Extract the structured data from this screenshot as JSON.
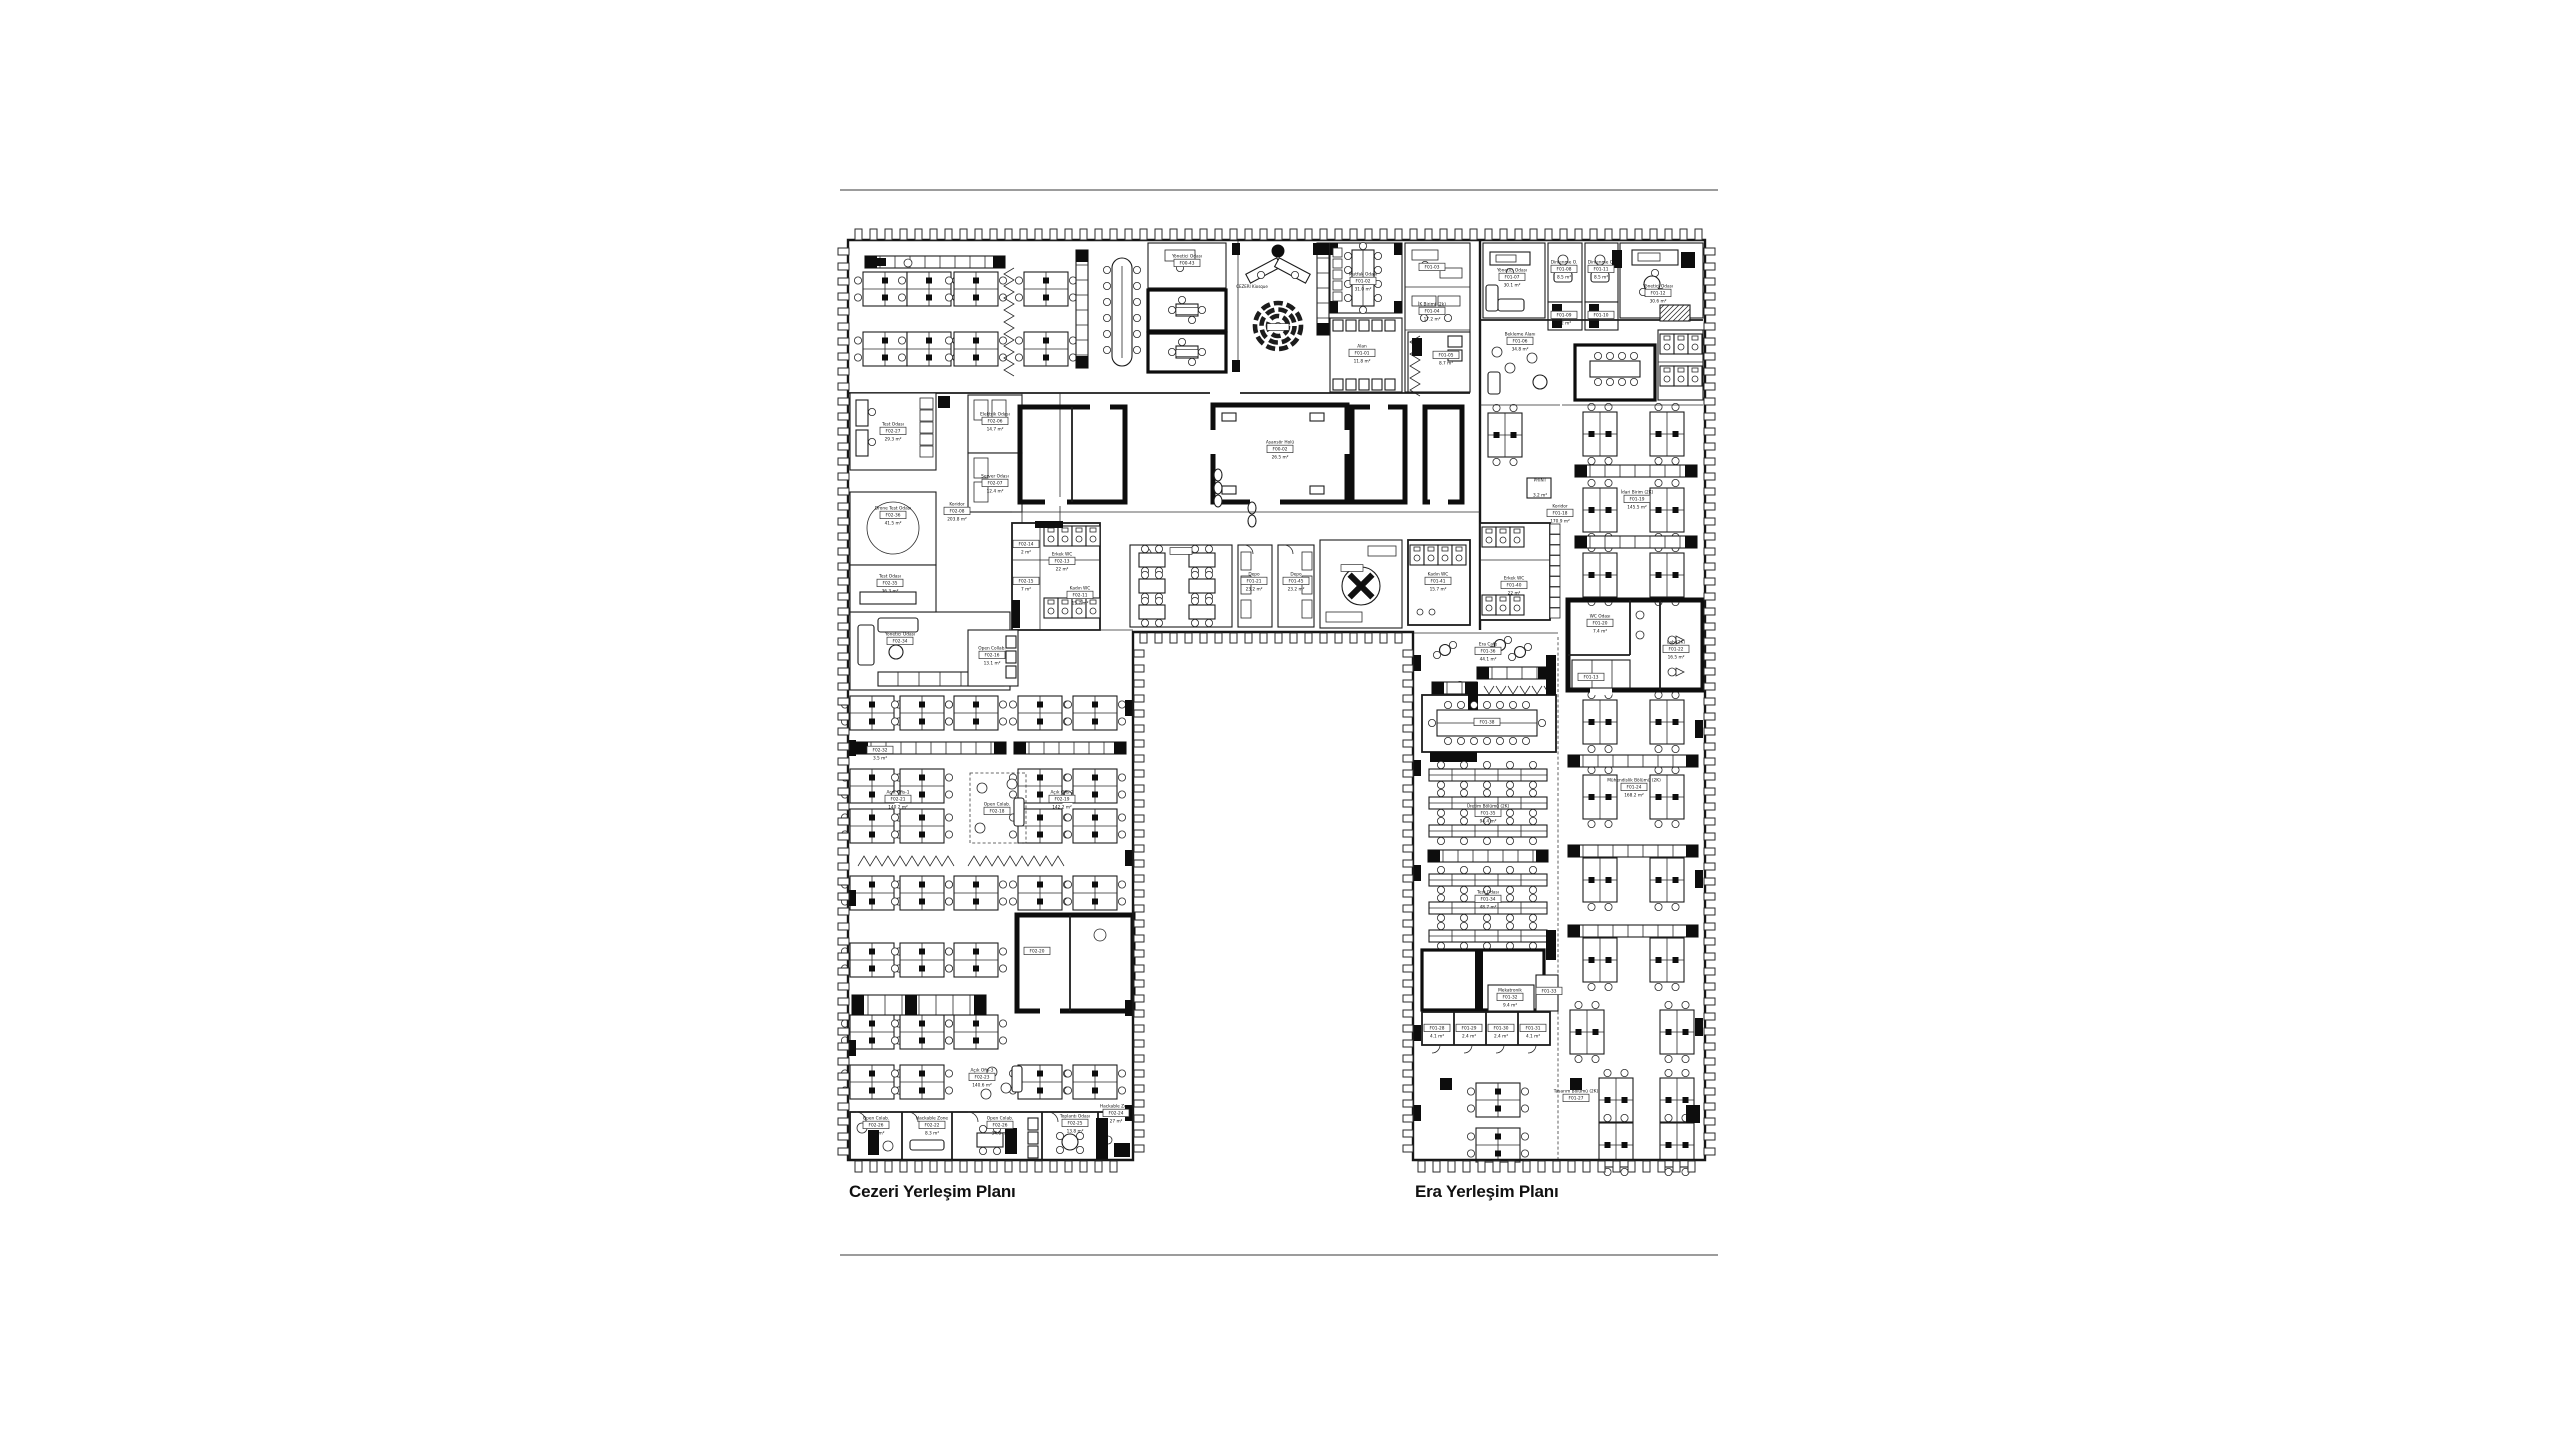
{
  "captions": {
    "cezeri": "Cezeri Yerleşim Planı",
    "era": "Era Yerleşim Planı"
  },
  "colors": {
    "ink": "#141414",
    "wall": "#161616",
    "rule": "#9c9c9c",
    "background": "#ffffff"
  },
  "small_texts": [
    {
      "t": "CEZERI Kiosque",
      "x": 1252,
      "y": 288
    }
  ],
  "rooms": [
    {
      "name": "Test Odası",
      "code": "F02-27",
      "area": "29.3 m²",
      "x": 893,
      "y": 430
    },
    {
      "name": "Elektrik Odası",
      "code": "F02-06",
      "area": "14.7 m²",
      "x": 995,
      "y": 420
    },
    {
      "name": "Server Odası",
      "code": "F02-07",
      "area": "12.4 m²",
      "x": 995,
      "y": 482
    },
    {
      "name": "Koridor",
      "code": "F02-08",
      "area": "203.8 m²",
      "x": 957,
      "y": 510
    },
    {
      "name": "Drone Test Odası",
      "code": "F02-36",
      "area": "41.5 m²",
      "x": 893,
      "y": 514
    },
    {
      "name": "Test Odası",
      "code": "F02-35",
      "area": "36.3 m²",
      "x": 890,
      "y": 582
    },
    {
      "name": "Yönetici Odası",
      "code": "F02-34",
      "area": "",
      "x": 900,
      "y": 640
    },
    {
      "name": "",
      "code": "F02-14",
      "area": "2 m²",
      "x": 1026,
      "y": 543
    },
    {
      "name": "",
      "code": "F02-15",
      "area": "7 m²",
      "x": 1026,
      "y": 580
    },
    {
      "name": "Erkek WC",
      "code": "F02-13",
      "area": "22 m²",
      "x": 1062,
      "y": 560
    },
    {
      "name": "Kadın WC",
      "code": "F02-11",
      "area": "15.7 m²",
      "x": 1080,
      "y": 594
    },
    {
      "name": "Yönetici Odası",
      "code": "F00-43",
      "area": "",
      "x": 1187,
      "y": 262
    },
    {
      "name": "Asansör Holü",
      "code": "F00-02",
      "area": "26.5 m²",
      "x": 1280,
      "y": 448
    },
    {
      "name": "Mutfak Odası",
      "code": "F01-02",
      "area": "31.0 m²",
      "x": 1363,
      "y": 280
    },
    {
      "name": "",
      "code": "F01-03",
      "area": "",
      "x": 1432,
      "y": 266
    },
    {
      "name": "İK Birimi (2k)",
      "code": "F01-04",
      "area": "17.2 m²",
      "x": 1432,
      "y": 310
    },
    {
      "name": "Alan",
      "code": "F01-01",
      "area": "11.8 m²",
      "x": 1362,
      "y": 352
    },
    {
      "name": "",
      "code": "F01-05",
      "area": "8.7 m²",
      "x": 1446,
      "y": 354
    },
    {
      "name": "Depo",
      "code": "F01-21",
      "area": "23.2 m²",
      "x": 1254,
      "y": 580
    },
    {
      "name": "Depo",
      "code": "F01-45",
      "area": "23.2 m²",
      "x": 1296,
      "y": 580
    },
    {
      "name": "Kadın WC",
      "code": "F01-41",
      "area": "15.7 m²",
      "x": 1438,
      "y": 580
    },
    {
      "name": "Erkek WC",
      "code": "F01-40",
      "area": "22 m²",
      "x": 1514,
      "y": 584
    },
    {
      "name": "Yönetici Odası",
      "code": "F01-07",
      "area": "30.1 m²",
      "x": 1512,
      "y": 276
    },
    {
      "name": "Dinlenme O.",
      "code": "F01-08",
      "area": "8.5 m²",
      "x": 1564,
      "y": 268
    },
    {
      "name": "",
      "code": "F01-09",
      "area": "3.2 m²",
      "x": 1564,
      "y": 314
    },
    {
      "name": "Dinlenme O.",
      "code": "F01-11",
      "area": "8.5 m²",
      "x": 1601,
      "y": 268
    },
    {
      "name": "",
      "code": "F01-10",
      "area": "",
      "x": 1601,
      "y": 314
    },
    {
      "name": "Yönetici Odası",
      "code": "F01-12",
      "area": "30.6 m²",
      "x": 1658,
      "y": 292
    },
    {
      "name": "Bekleme Alanı",
      "code": "F01-06",
      "area": "34.8 m²",
      "x": 1520,
      "y": 340
    },
    {
      "name": "PRINT",
      "code": "",
      "area": "3.2 m²",
      "x": 1540,
      "y": 486
    },
    {
      "name": "Koridor",
      "code": "F01-18",
      "area": "170.9 m²",
      "x": 1560,
      "y": 512
    },
    {
      "name": "İdari Birim (2K)",
      "code": "F01-19",
      "area": "145.5 m²",
      "x": 1637,
      "y": 498
    },
    {
      "name": "Era Cafe",
      "code": "F01-36",
      "area": "44.1 m²",
      "x": 1488,
      "y": 650
    },
    {
      "name": "",
      "code": "F01-38",
      "area": "",
      "x": 1487,
      "y": 721
    },
    {
      "name": "WC Odası",
      "code": "F01-20",
      "area": "7.4 m²",
      "x": 1600,
      "y": 622
    },
    {
      "name": "Lab (2K)",
      "code": "F01-22",
      "area": "16.5 m²",
      "x": 1676,
      "y": 648
    },
    {
      "name": "",
      "code": "F01-13",
      "area": "",
      "x": 1591,
      "y": 676
    },
    {
      "name": "Üretim Bölümü (2K)",
      "code": "F01-35",
      "area": "94.4 m²",
      "x": 1488,
      "y": 812
    },
    {
      "name": "Test Odası",
      "code": "F01-34",
      "area": "48.7 m²",
      "x": 1488,
      "y": 898
    },
    {
      "name": "Mühendislik Bölümü (2K)",
      "code": "F01-24",
      "area": "168.2 m²",
      "x": 1634,
      "y": 786
    },
    {
      "name": "Mekatronik",
      "code": "F01-32",
      "area": "9.4 m²",
      "x": 1510,
      "y": 996
    },
    {
      "name": "",
      "code": "F01-33",
      "area": "",
      "x": 1549,
      "y": 990
    },
    {
      "name": "",
      "code": "F01-28",
      "area": "4.1 m²",
      "x": 1437,
      "y": 1027
    },
    {
      "name": "",
      "code": "F01-29",
      "area": "2.4 m²",
      "x": 1469,
      "y": 1027
    },
    {
      "name": "",
      "code": "F01-30",
      "area": "2.4 m²",
      "x": 1501,
      "y": 1027
    },
    {
      "name": "",
      "code": "F01-31",
      "area": "4.1 m²",
      "x": 1533,
      "y": 1027
    },
    {
      "name": "Tasarım Bölümü (2K)",
      "code": "F01-27",
      "area": "",
      "x": 1576,
      "y": 1097
    },
    {
      "name": "",
      "code": "F02-32",
      "area": "3.5 m²",
      "x": 880,
      "y": 749
    },
    {
      "name": "Açık Ofis-1",
      "code": "F02-21",
      "area": "140.2 m²",
      "x": 898,
      "y": 798
    },
    {
      "name": "Open Colab.",
      "code": "F02-18",
      "area": "",
      "x": 997,
      "y": 810
    },
    {
      "name": "Açık Ofis-2",
      "code": "F02-19",
      "area": "142.2 m²",
      "x": 1062,
      "y": 798
    },
    {
      "name": "Open Collab.",
      "code": "F02-16",
      "area": "13.1 m²",
      "x": 992,
      "y": 654
    },
    {
      "name": "",
      "code": "F02-20",
      "area": "",
      "x": 1037,
      "y": 950
    },
    {
      "name": "Açık Ofis-3",
      "code": "F02-23",
      "area": "140.6 m²",
      "x": 982,
      "y": 1076
    },
    {
      "name": "Open Colab.",
      "code": "F02-26",
      "area": "12.2 m²",
      "x": 876,
      "y": 1124
    },
    {
      "name": "Hackable Zone",
      "code": "F02-22",
      "area": "8.3 m²",
      "x": 932,
      "y": 1124
    },
    {
      "name": "Open Colab.",
      "code": "F02-26",
      "area": "34.8 m²",
      "x": 1000,
      "y": 1124
    },
    {
      "name": "Toplantı Odası",
      "code": "F02-25",
      "area": "13.8 m²",
      "x": 1075,
      "y": 1122
    },
    {
      "name": "Hackable Zone",
      "code": "F02-24",
      "area": "27 m²",
      "x": 1116,
      "y": 1112
    }
  ]
}
